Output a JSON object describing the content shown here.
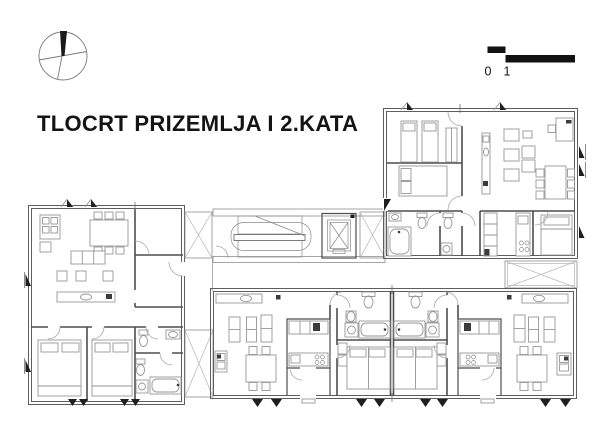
{
  "title": "TLOCRT PRIZEMLJA I 2.KATA",
  "scale_bar": {
    "labels": [
      "0",
      "1",
      "5"
    ]
  },
  "icons": {
    "compass": "north-arrow-compass",
    "scale": "graphic-scale-bar",
    "elevator": "elevator-shaft",
    "stairs": "double-flight-stairs"
  },
  "colors": {
    "background": "#ffffff",
    "ink": "#141414",
    "wall": "#4d4d4d",
    "furniture": "#969696"
  }
}
